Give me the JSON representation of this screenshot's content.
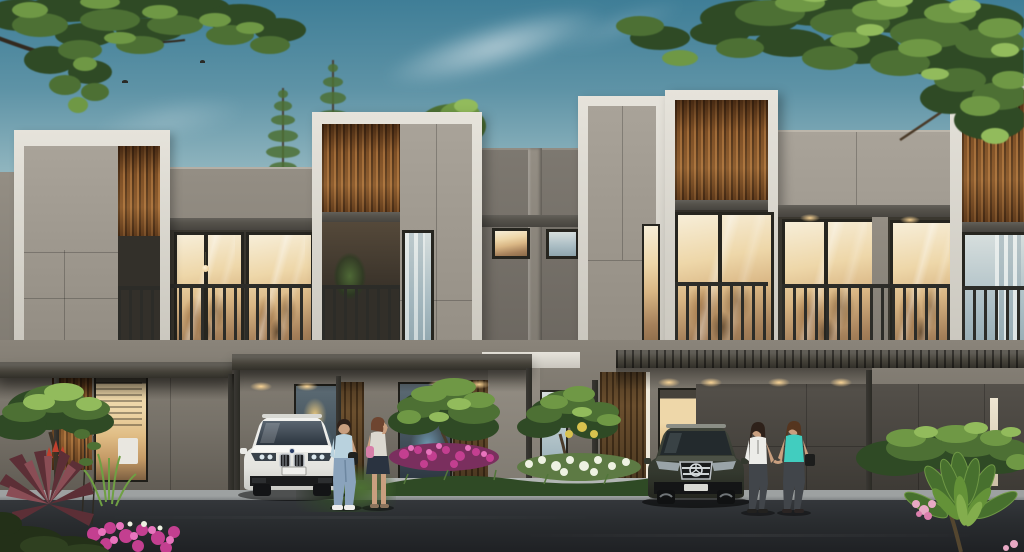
{
  "meta": {
    "kind": "architectural-exterior-render",
    "width_px": 1024,
    "height_px": 552,
    "text_visible": "none"
  },
  "palette": {
    "sky_top": "#3f7e97",
    "sky_mid": "#93b7c0",
    "sky_horizon": "#ece7d8",
    "frame_white": "#e6e3db",
    "frame_shade": "#c9c6bd",
    "panel_light": "#a9a399",
    "panel_mid": "#948e84",
    "wall_dark": "#7d7870",
    "wood_hi": "#a06b38",
    "wood_mid": "#7d4f26",
    "wood_lo": "#54351a",
    "fascia": "#55524b",
    "slab": "#45423c",
    "slab_hi": "#5f5c55",
    "win_frame": "#26251f",
    "glass_warm_hi": "#f7eed8",
    "glass_warm": "#eed7a9",
    "glass_warm_lo": "#8a6a48",
    "glass_cool_hi": "#d6dedd",
    "glass_cool": "#a9bcc3",
    "railing": "#2c2c28",
    "ground_wall": "#8a847a",
    "ground_wall_lo": "#5f5a52",
    "panel_dark": "#54504a",
    "panel_dark_lo": "#3c3934",
    "door_wood": "#6b4f2e",
    "door_wood_lo": "#46311a",
    "canopy": "#454239",
    "post": "#2b2a25",
    "curb_top": "#9da1a1",
    "curb_face": "#686c6e",
    "island_curb": "#b2b6b4",
    "road": "#34373b",
    "road_lo": "#1f2124",
    "leaf_dark": "#2f4a25",
    "leaf_mid": "#4d7034",
    "leaf_light": "#6f9845",
    "leaf_bright": "#92bb5c",
    "trunk": "#3a2f22",
    "cordyline": "#5c2f36",
    "cordyline_hi": "#8a4d55",
    "flower_magenta": "#c33f90",
    "flower_pink": "#e874bd",
    "flower_white": "#eef2e2",
    "flower_soft": "#e8a9c4",
    "car_white": "#f2f2ef",
    "car_white_lo": "#c9c9c4",
    "car_dark": "#41463c",
    "car_dark_lo": "#24261f",
    "skin": "#c99f7f",
    "denim": "#8aa3bc",
    "tee_blue": "#b9d2de",
    "top_white": "#dbd8cf",
    "skirt_dark": "#2a3340",
    "tee_white": "#ecece8",
    "pants_dark": "#41454a",
    "top_teal": "#41cdbf",
    "hair_dark": "#2e211a",
    "hair_auburn": "#6e4530",
    "hair_brown": "#55351f"
  },
  "scene": {
    "setting": "dusk",
    "elements": [
      "sky-gradient",
      "wispy-clouds",
      "flying-birds",
      "overhanging-tree-canopy-left",
      "overhanging-tree-canopy-right",
      "background-conifer-trees",
      "modern-townhouse-row",
      "white-box-frames",
      "wood-slat-accent-panels",
      "second-floor-balconies-with-dark-railings",
      "warm-lit-interior-windows",
      "flat-roof-carports-with-posts",
      "recessed-downlights",
      "white-suv-front-view",
      "dark-suv-front-view",
      "two-women-standing-by-white-suv",
      "two-women-walking-holding-hands",
      "landscaped-garden-island",
      "magenta-flower-bed",
      "white-flower-bed",
      "cordyline-and-bougainvillea-corner-left",
      "frangipani-plant-corner-right",
      "asphalt-road",
      "concrete-curb"
    ]
  }
}
